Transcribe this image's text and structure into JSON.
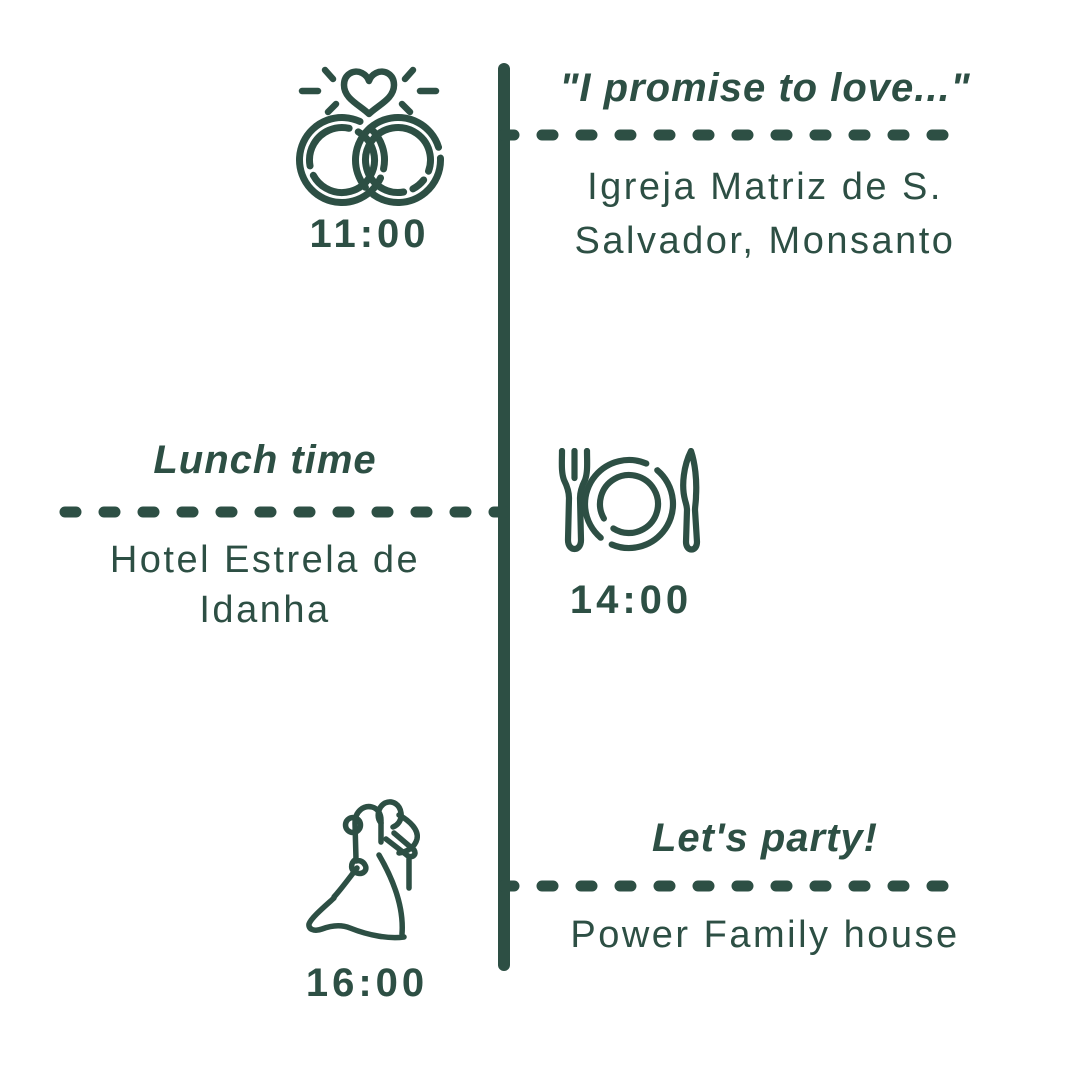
{
  "meta": {
    "description": "Wedding day timeline poster",
    "axis": "vertical-center-line"
  },
  "palette": {
    "ink": "#2d4f44",
    "background": "#ffffff"
  },
  "events": [
    {
      "id": "ceremony",
      "side": "right",
      "time": "11:00",
      "title": "\"I promise to love...\"",
      "location_lines": [
        "Igreja Matriz de S.",
        "Salvador, Monsanto"
      ],
      "icon": "wedding-rings-heart-icon"
    },
    {
      "id": "lunch",
      "side": "left",
      "time": "14:00",
      "title": "Lunch time",
      "location_lines": [
        "Hotel Estrela de",
        "Idanha"
      ],
      "icon": "dinner-plate-cutlery-icon"
    },
    {
      "id": "party",
      "side": "right",
      "time": "16:00",
      "title": "Let's party!",
      "location_lines": [
        "Power Family house"
      ],
      "icon": "dancing-couple-icon"
    }
  ]
}
